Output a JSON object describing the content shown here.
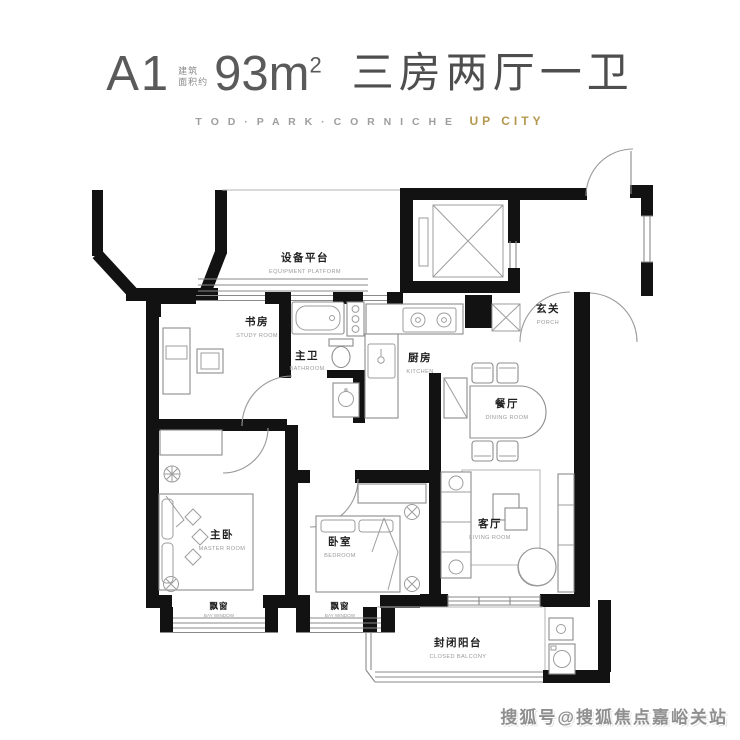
{
  "title": {
    "unit": "A1",
    "area_prefix_line1": "建筑",
    "area_prefix_line2": "面积约",
    "area_value": "93m",
    "area_sup": "2",
    "rooms_summary": "三房两厅一卫",
    "subtitle_brand": "T O D · P A R K · C O R N I C H E",
    "subtitle_project": "UP CITY"
  },
  "rooms": {
    "equipment_platform": {
      "cn": "设备平台",
      "en": "EQUIPMENT PLATFORM"
    },
    "study": {
      "cn": "书房",
      "en": "STUDY ROOM"
    },
    "master_bath": {
      "cn": "主卫",
      "en": "BATHROOM"
    },
    "kitchen": {
      "cn": "厨房",
      "en": "KITCHEN"
    },
    "porch": {
      "cn": "玄关",
      "en": "PORCH"
    },
    "dining": {
      "cn": "餐厅",
      "en": "DINING ROOM"
    },
    "master_bedroom": {
      "cn": "主卧",
      "en": "MASTER ROOM"
    },
    "bedroom": {
      "cn": "卧室",
      "en": "BEDROOM"
    },
    "living": {
      "cn": "客厅",
      "en": "LIVING ROOM"
    },
    "bay_window_1": {
      "cn": "飘窗",
      "en": "BAY WINDOW"
    },
    "bay_window_2": {
      "cn": "飘窗",
      "en": "BAY WINDOW"
    },
    "balcony": {
      "cn": "封闭阳台",
      "en": "CLOSED BALCONY"
    }
  },
  "watermark": {
    "text": "搜狐号@搜狐焦点嘉峪关站"
  },
  "colors": {
    "wall": "#121212",
    "thin_line": "#8a8a8a",
    "accent_gold": "#b5984f",
    "title_text": "#4e4e4e",
    "label_cn": "#1f1f1f",
    "label_en": "#9a9a9a",
    "watermark": "#8f8f8f"
  }
}
